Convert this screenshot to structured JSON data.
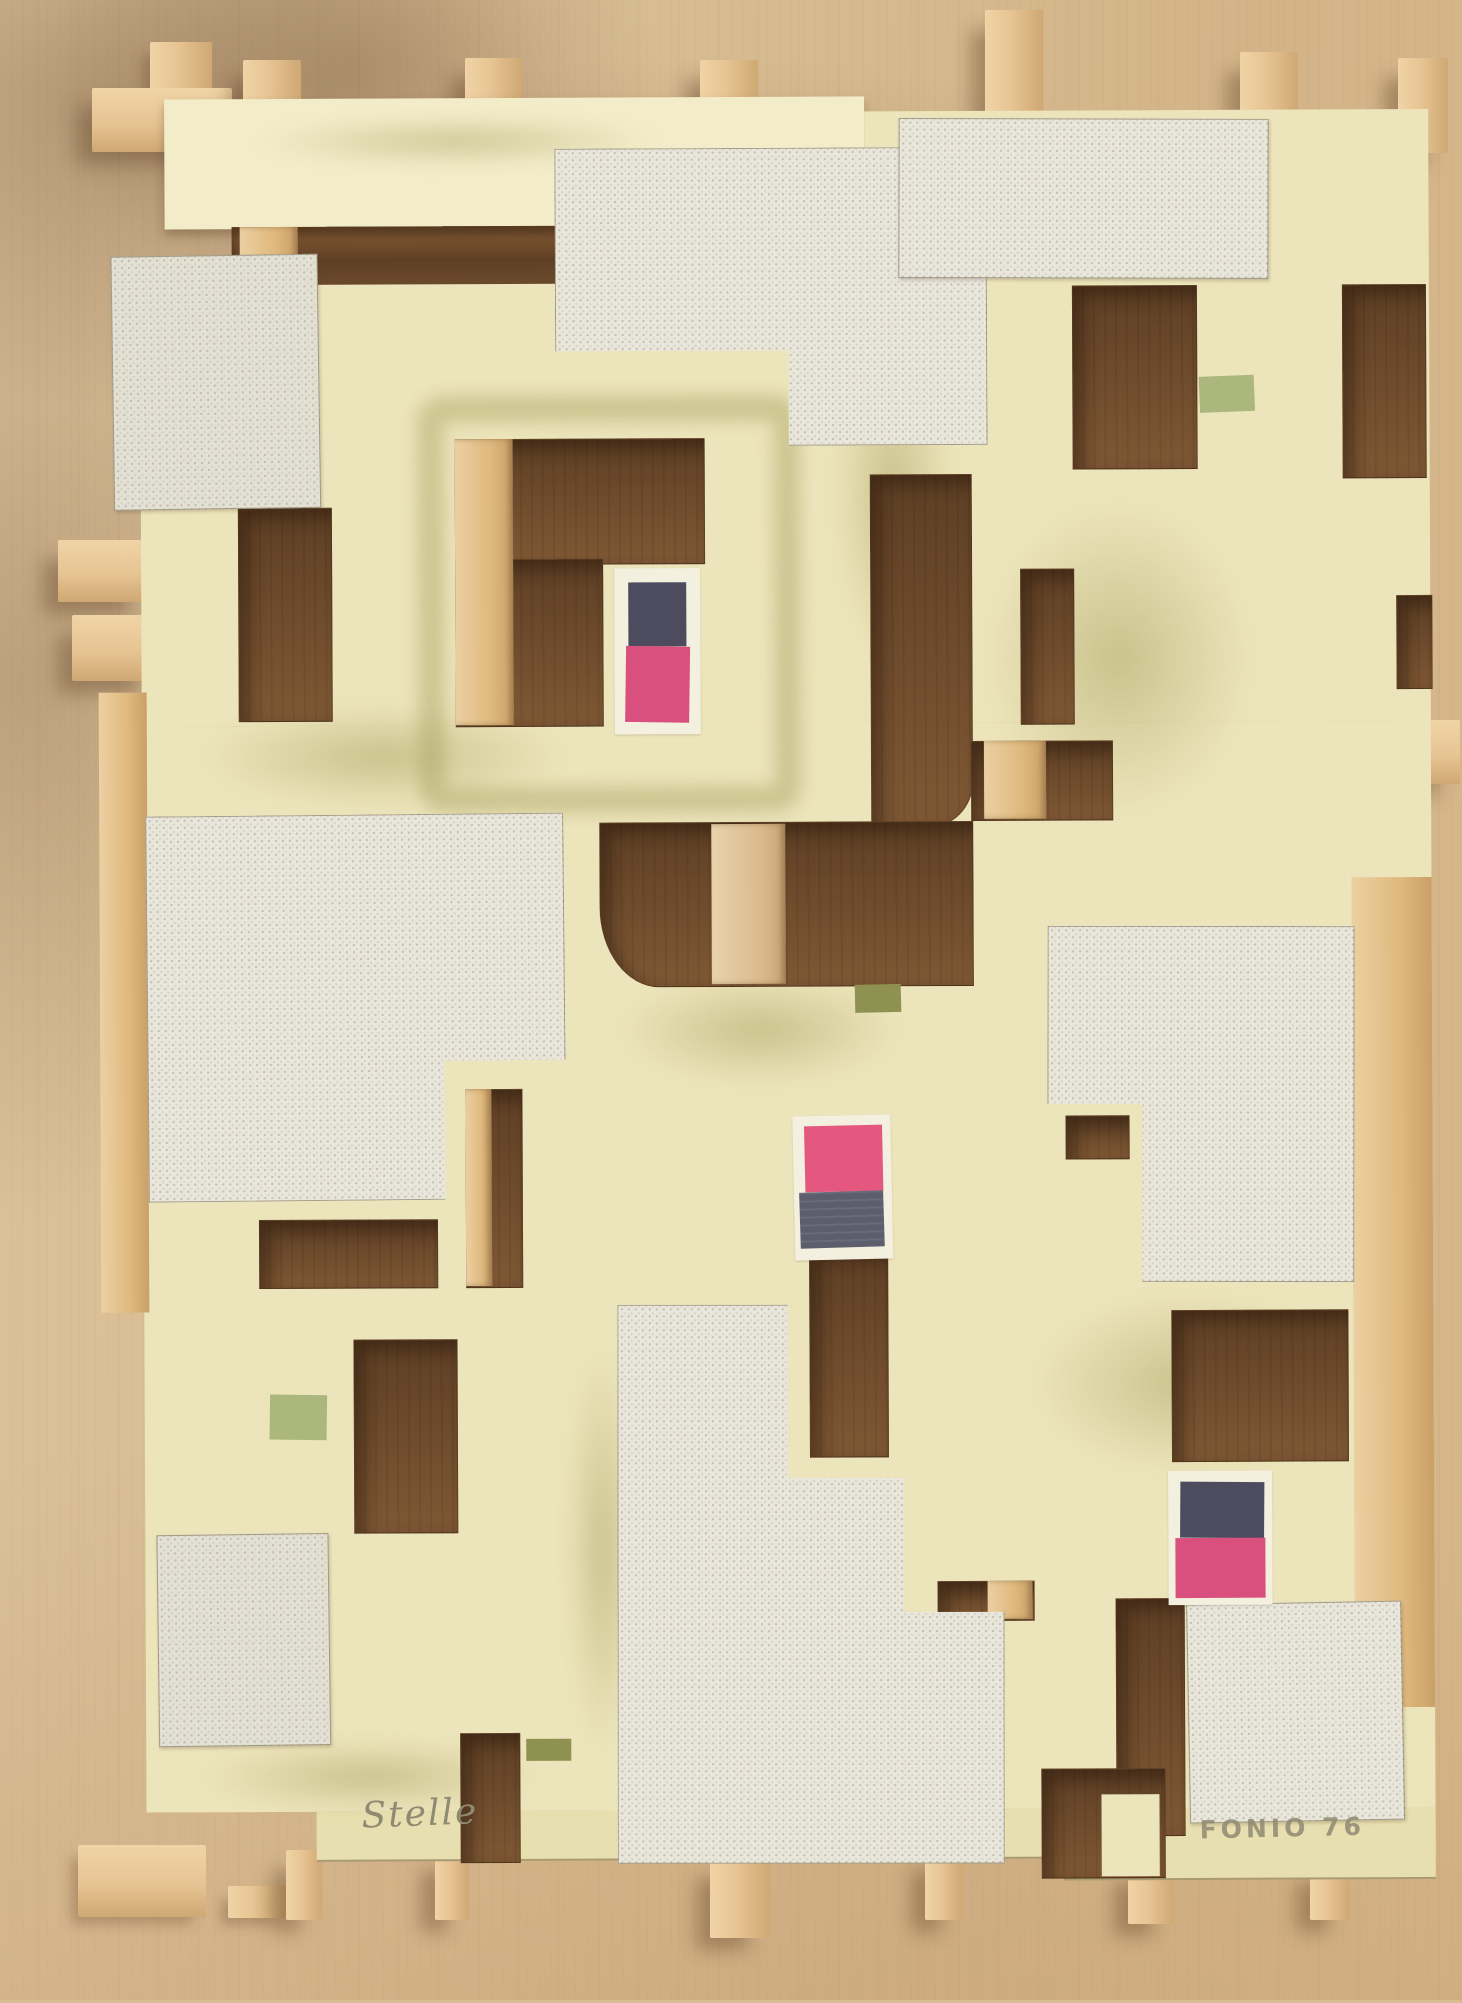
{
  "artwork": {
    "signature_left": "Stelle",
    "signature_right": "FONIO 76",
    "palette": {
      "bg_wood": "#d8bc92",
      "bg_wood_dark": "#c3a478",
      "stick": "#e7c493",
      "stick_dark": "#cfa873",
      "panel": "#ece4ba",
      "panel_light": "#f2ecc8",
      "wash": "#a8a060",
      "hole_dark": "#5e3f24",
      "hole_light": "#7c5633",
      "canvas": "#e9e6dc",
      "canvas_gray": "#e3e0d4",
      "pink": "#d94f7d",
      "pink_bright": "#e4577f",
      "navy": "#4c4c5e",
      "navy_gray": "#5c5e6e",
      "sage": "#abb77c",
      "olive": "#8f9150",
      "pencil": "#8f8a72"
    }
  }
}
